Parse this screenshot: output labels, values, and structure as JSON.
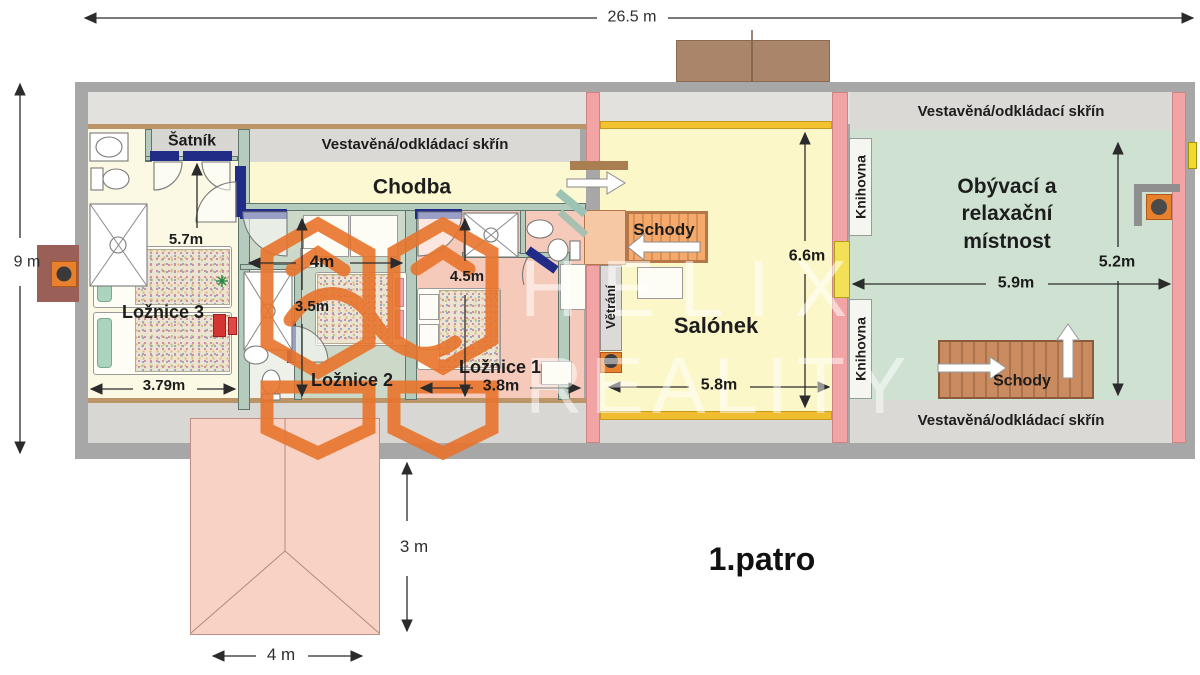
{
  "floor_label": "1.patro",
  "rooms": {
    "satnik": "Šatník",
    "vestavena": "Vestavěná/odkládací skřín",
    "chodba": "Chodba",
    "loznice3": "Ložnice 3",
    "loznice2": "Ložnice 2",
    "loznice1": "Ložnice 1",
    "schody": "Schody",
    "salonek": "Salónek",
    "vetrani": "Větrání",
    "knihovna": "Knihovna",
    "obyvaci": "Obývací a relaxační místnost"
  },
  "dims": {
    "total_w": "26.5 m",
    "total_h": "9 m",
    "satnik_len": "5.7m",
    "l3_w": "3.79m",
    "l2_w": "4m",
    "l2_h": "3.5m",
    "l1_h": "4.5m",
    "l1_w": "3.8m",
    "salonek_h": "6.6m",
    "salonek_w": "5.8m",
    "obyvaci_w": "5.9m",
    "obyvaci_h": "5.2m",
    "annex_h": "3 m",
    "annex_w": "4 m"
  },
  "watermark": {
    "line1": "HELIX",
    "line2": "REALITY"
  },
  "colors": {
    "logo_orange": "#E8742C",
    "door_navy": "#202c86",
    "wall_pink": "#f2a3a3",
    "stairs_orange": "#f5a96b",
    "stairs_brown": "#cb8b60",
    "room_yellow": "#fcf7c8",
    "room_green": "#cfe2d2",
    "room_pink": "#f6cabb",
    "room_sage": "#ccd8c8",
    "roof_pink": "#f8d3c5"
  }
}
